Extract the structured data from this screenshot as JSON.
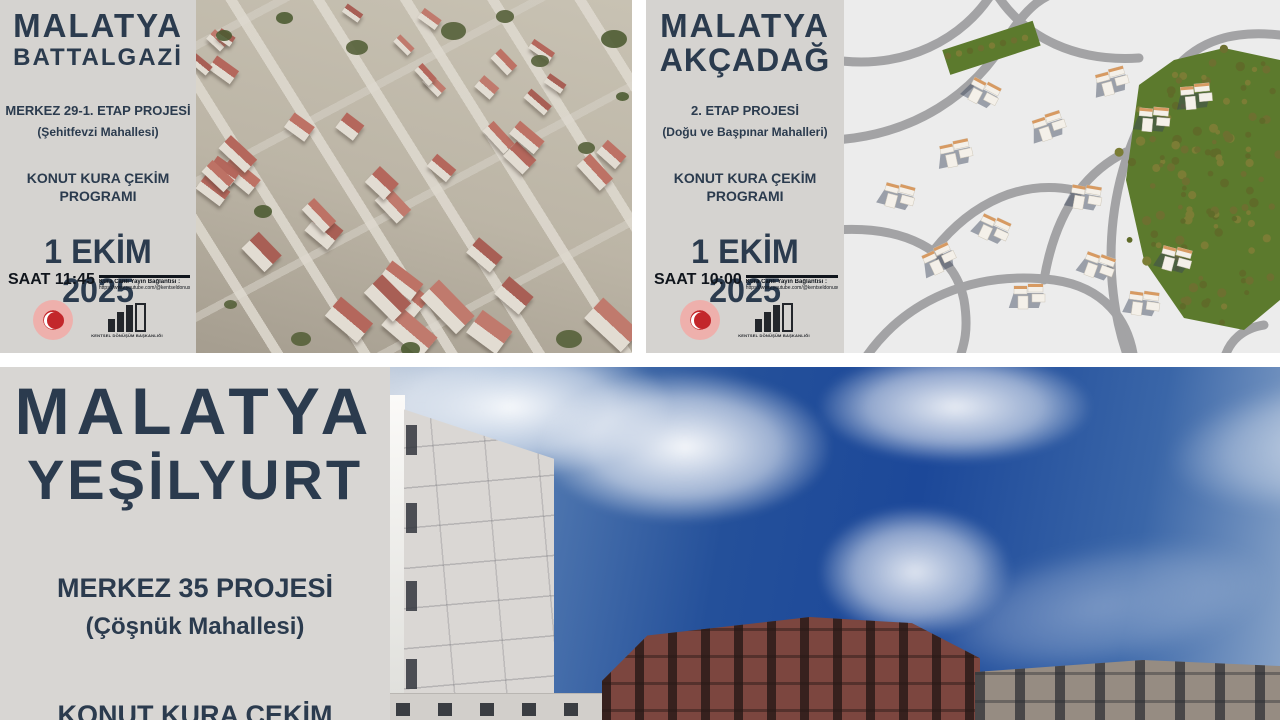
{
  "posters": {
    "battalgazi": {
      "city": "MALATYA",
      "district": "BATTALGAZİ",
      "project": "MERKEZ 29-1. ETAP PROJESİ",
      "neighborhood": "(Şehitfevzi Mahallesi)",
      "program_line1": "KONUT KURA ÇEKİM",
      "program_line2": "PROGRAMI",
      "date": "1 EKİM 2025",
      "time": "SAAT 11:45",
      "stream_label": "Kura Canlı Yayın Bağlantısı :",
      "stream_url": "https://www.youtube.com/@kentseldonusumbaskanligi"
    },
    "akcadag": {
      "city": "MALATYA",
      "district": "AKÇADAĞ",
      "project": "2. ETAP PROJESİ",
      "neighborhood": "(Doğu ve Başpınar Mahalleri)",
      "program_line1": "KONUT KURA ÇEKİM",
      "program_line2": "PROGRAMI",
      "date": "1 EKİM 2025",
      "time": "SAAT 10:00",
      "stream_label": "Kura Canlı Yayın Bağlantısı :",
      "stream_url": "https://www.youtube.com/@kentseldonusumbaskanligi"
    },
    "yesilyurt": {
      "city": "MALATYA",
      "district": "YEŞİLYURT",
      "project": "MERKEZ 35 PROJESİ",
      "neighborhood": "(Çöşnük Mahallesi)",
      "program_partial": "KONUT KURA ÇEKİM"
    }
  },
  "logos": {
    "agency_caption": "KENTSEL DÖNÜŞÜM BAŞKANLIĞI"
  },
  "colors": {
    "title_text": "#2b3b4e",
    "panel_background": "#d5d3d0",
    "date_text": "#10151c",
    "ministry_red": "#c3272b",
    "park_green": "#5c7a2d",
    "sky_blue": "#1c4899"
  }
}
